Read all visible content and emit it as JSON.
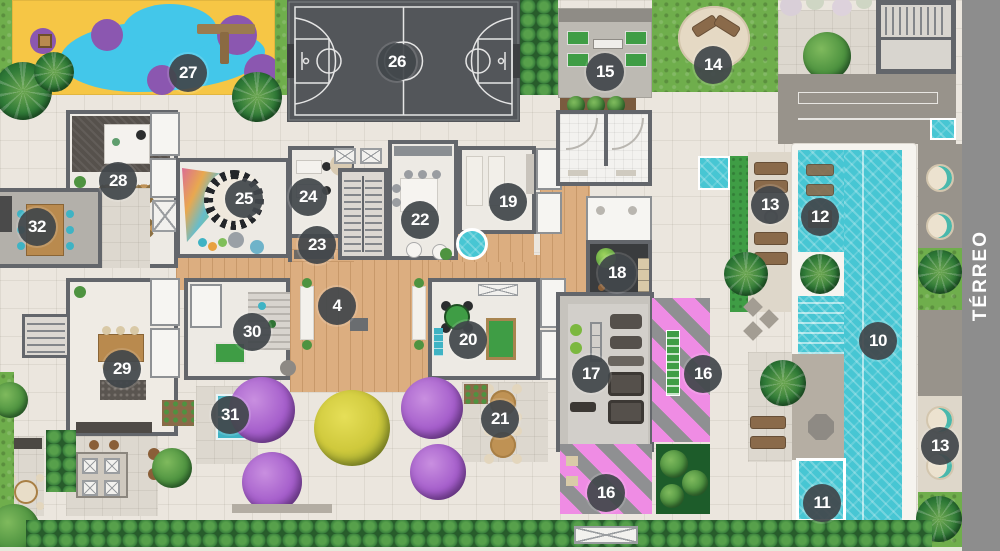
{
  "meta": {
    "floor_label": "TÉRREO"
  },
  "palette": {
    "paving": "#ebe6de",
    "wall": "#63666b",
    "wood": "#dcae80",
    "court": "#53565a",
    "court_line": "#e5e5e5",
    "water": "#47c6d3",
    "pool_edge": "#f6f4ef",
    "grass": "#6fae4c",
    "hedge": "#2e7333",
    "pink": "#ef8ce4",
    "pink_stripe": "#8f9092",
    "badge": "rgba(66,71,75,.93)",
    "sidebar": "#8d8d8d",
    "carpet": "#56514c",
    "purple_tree": "#a55ecb",
    "yellow_tree": "#cfc93c",
    "teal": "#3fb3c4",
    "lounger": "#8a6a4a",
    "deck": "#ded7ca",
    "taupe": "#98938b"
  },
  "badges": [
    {
      "label": "27",
      "x": 188,
      "y": 73
    },
    {
      "label": "26",
      "x": 397,
      "y": 62
    },
    {
      "label": "15",
      "x": 605,
      "y": 72
    },
    {
      "label": "14",
      "x": 713,
      "y": 65
    },
    {
      "label": "28",
      "x": 118,
      "y": 181
    },
    {
      "label": "32",
      "x": 37,
      "y": 227
    },
    {
      "label": "25",
      "x": 244,
      "y": 199
    },
    {
      "label": "24",
      "x": 308,
      "y": 197
    },
    {
      "label": "23",
      "x": 317,
      "y": 245
    },
    {
      "label": "22",
      "x": 420,
      "y": 220
    },
    {
      "label": "19",
      "x": 508,
      "y": 202
    },
    {
      "label": "18",
      "x": 617,
      "y": 273
    },
    {
      "label": "4",
      "x": 337,
      "y": 306
    },
    {
      "label": "30",
      "x": 252,
      "y": 332
    },
    {
      "label": "20",
      "x": 468,
      "y": 340
    },
    {
      "label": "17",
      "x": 591,
      "y": 374
    },
    {
      "label": "16",
      "x": 703,
      "y": 374
    },
    {
      "label": "29",
      "x": 122,
      "y": 369
    },
    {
      "label": "31",
      "x": 230,
      "y": 415
    },
    {
      "label": "21",
      "x": 500,
      "y": 419
    },
    {
      "label": "16",
      "x": 606,
      "y": 493
    },
    {
      "label": "10",
      "x": 878,
      "y": 341
    },
    {
      "label": "11",
      "x": 822,
      "y": 503
    },
    {
      "label": "12",
      "x": 820,
      "y": 217
    },
    {
      "label": "13",
      "x": 770,
      "y": 205
    },
    {
      "label": "13",
      "x": 940,
      "y": 446
    }
  ]
}
